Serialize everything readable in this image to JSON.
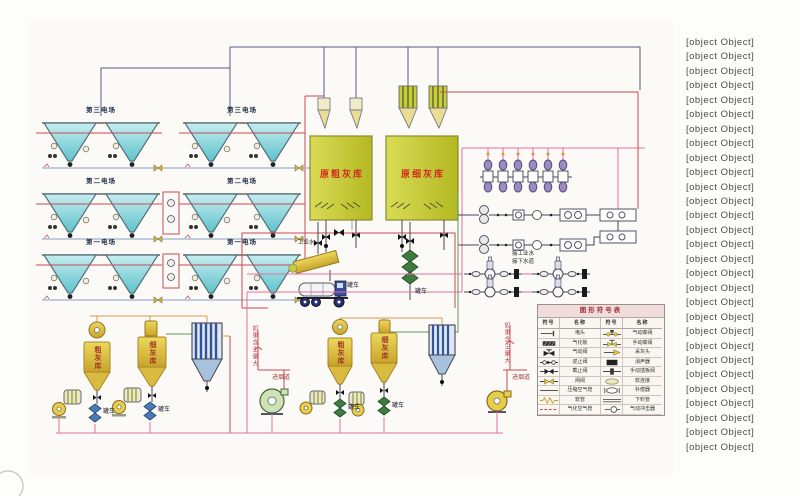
{
  "colors": {
    "pipe_red": "#c84b52",
    "pipe_pink": "#e070a0",
    "pipe_navy": "#5a5a88",
    "pipe_blue": "#9ab0cc",
    "pipe_orange": "#d89858",
    "pipe_green": "#5f9a5f",
    "hopper_cyan": "#6fc8cf",
    "silo_yellow": "#d9c23a",
    "filter_blue": "#31549a",
    "ash_silo_yellow_green": "#c9cf3a",
    "label_red": "#d42a1e"
  },
  "esp": {
    "fields": [
      "第三电场",
      "第二电场",
      "第一电场"
    ]
  },
  "tanks": {
    "coarse": "原粗灰库",
    "fine": "原细灰库"
  },
  "silos": {
    "coarse": "粗灰库",
    "fine": "细灰库"
  },
  "labels": {
    "industrial_water": "工业水",
    "tanker": "罐车",
    "connect_industrial_water": "接工业水",
    "connect_sewer": "接下水道",
    "if_dust_high": "如果含尘量大",
    "to_flue": "进烟道"
  },
  "symbol_table": {
    "title": "图形符号表",
    "col_symbol": "符号",
    "col_name": "名称",
    "rows": [
      {
        "l_sym": "plug",
        "l_name": "堵头",
        "r_sym": "pneu-butterfly",
        "r_name": "气动蝶阀"
      },
      {
        "l_sym": "plate",
        "l_name": "气化板",
        "r_sym": "man-butterfly",
        "r_name": "手动蝶阀"
      },
      {
        "l_sym": "pneu-valve",
        "l_name": "气动阀",
        "r_sym": "pickup",
        "r_name": "采灰头"
      },
      {
        "l_sym": "check",
        "l_name": "逆止阀",
        "r_sym": "silencer",
        "r_name": "消声器"
      },
      {
        "l_sym": "stop",
        "l_name": "截止阀",
        "r_sym": "slide-gate",
        "r_name": "手动插板阀"
      },
      {
        "l_sym": "gate",
        "l_name": "闸阀",
        "r_sym": "soft",
        "r_name": "软连接"
      },
      {
        "l_sym": "airline",
        "l_name": "压缩空气管",
        "r_sym": "compensator",
        "r_name": "补偿器"
      },
      {
        "l_sym": "hose",
        "l_name": "软管",
        "r_sym": "downpipe",
        "r_name": "下料管"
      },
      {
        "l_sym": "aerline",
        "l_name": "气化空气管",
        "r_sym": "aircannon",
        "r_name": "气动冲击器"
      }
    ]
  },
  "legend": {
    "items": [
      "1、电动锁气器",
      "2、气化板",
      "3、排料阀",
      "4、电加热阀",
      "5、灰斗气化风机",
      "6、旋风分离器",
      "7、重锤式锁气器",
      "8、组合式布袋除尘器",
      "9、电动锁气器",
      "10、罗茨真空泵",
      "11、螺杆空气压缩机",
      "12、冷冻干燥器",
      "13、储气罐",
      "14、原灰库气化风机",
      "15、旋转卸料器",
      "16、干灰散装机",
      "17、电加热器",
      "18、湿式搅拌器",
      "19、粉煤灰罐车",
      "20、高压离心风机",
      "21、脉冲布袋防尘器",
      "22、旋转供料器",
      "23、多管收集器",
      "24、电动锁气器",
      "25、分选机",
      "26、罗茨鼓风机",
      "27、气动卸料阀",
      "28、袋式过滤器",
      "29、引风机"
    ]
  }
}
